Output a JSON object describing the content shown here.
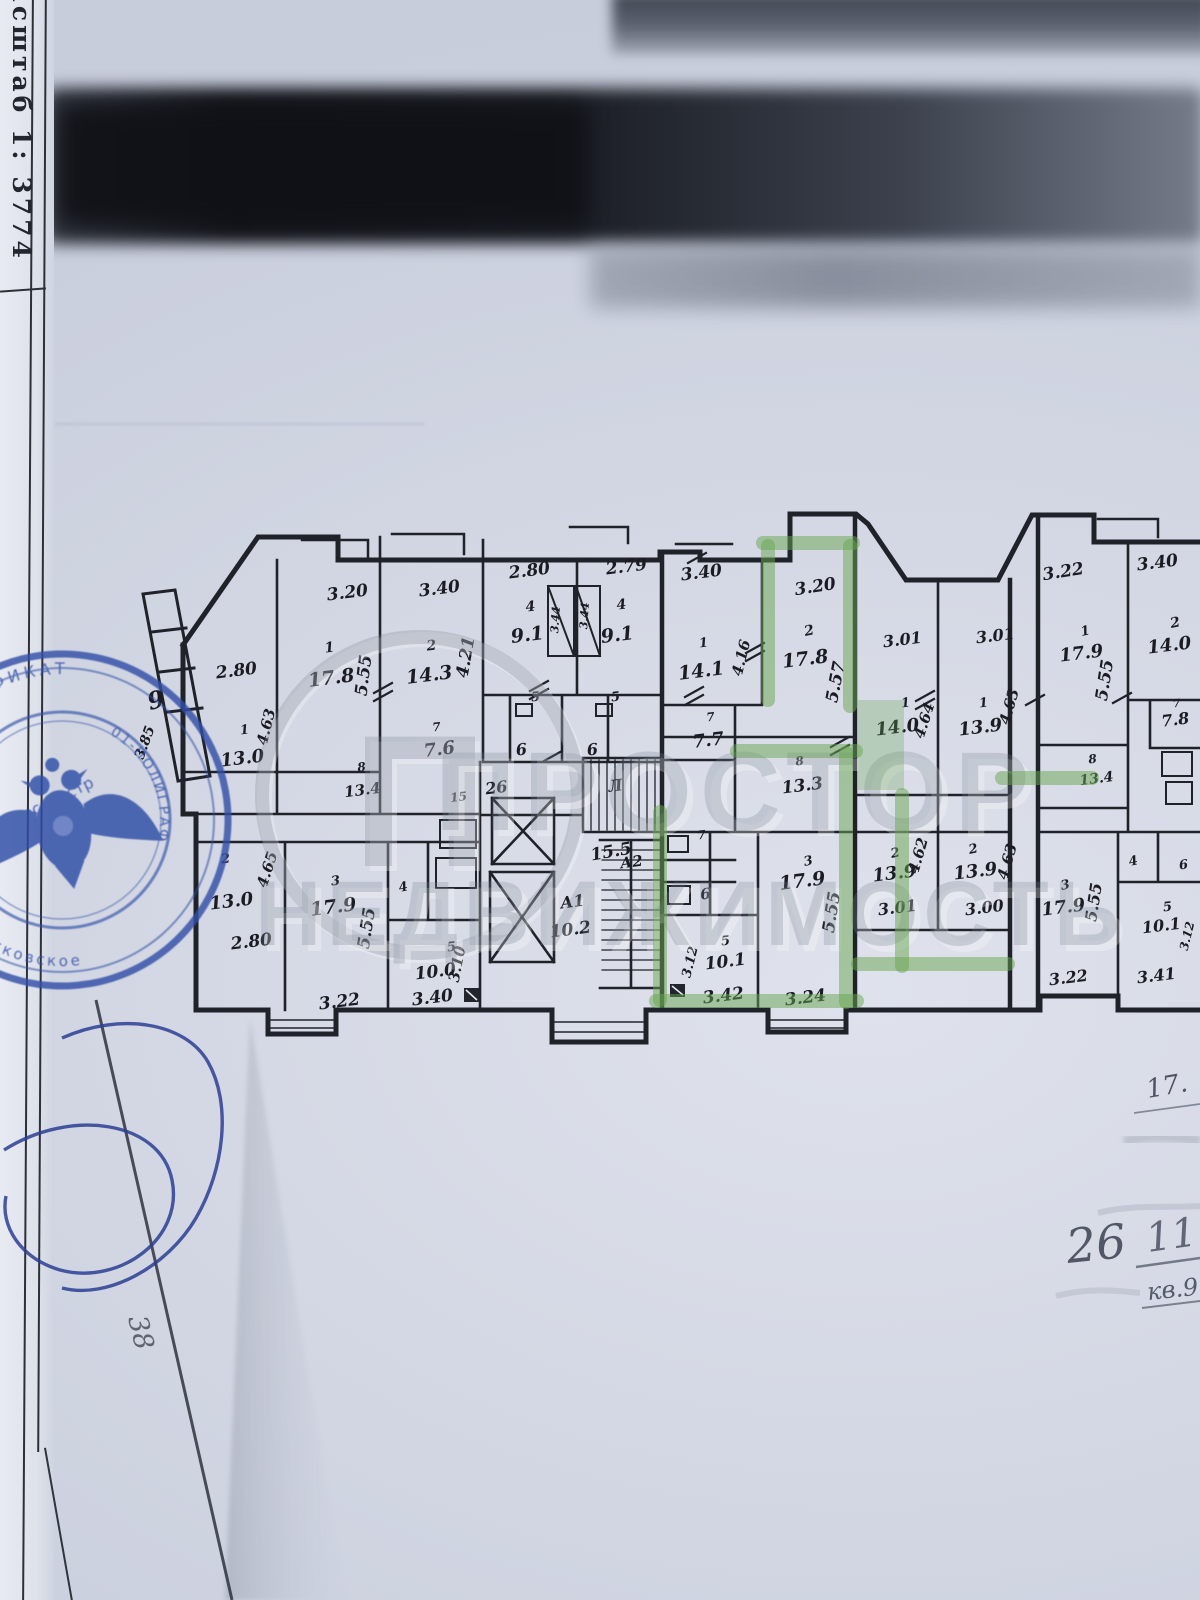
{
  "title_block": {
    "scale_label": "Масштаб 1:",
    "scale_value": "3774"
  },
  "watermark": {
    "logo_letter": "П",
    "line1": "ПРОСТОР",
    "line2": "НЕДВИЖИМОСТЬ"
  },
  "stamp": {
    "arc_top": "СЕРТИФИКАТ",
    "arc_left": "ное государственное",
    "word_center": "Росреестр",
    "arc_bottom": "Московское",
    "arc_right": "01-ПОЛИГРАФ",
    "small": "ОКПО"
  },
  "handwritten": {
    "floor_note": "17.",
    "entry_number": "26",
    "flat_number": "11",
    "apartment_note": "кв.9",
    "corner_mark": "38"
  },
  "plan": {
    "labels": [
      {
        "x": 348,
        "y": 598,
        "t": "3.20"
      },
      {
        "x": 330,
        "y": 652,
        "t": "1",
        "s": 14
      },
      {
        "x": 332,
        "y": 684,
        "t": "17.8",
        "s": 19
      },
      {
        "x": 369,
        "y": 676,
        "t": "5.55",
        "r": -83
      },
      {
        "x": 440,
        "y": 594,
        "t": "3.40"
      },
      {
        "x": 432,
        "y": 650,
        "t": "2",
        "s": 14
      },
      {
        "x": 430,
        "y": 681,
        "t": "14.3",
        "s": 19
      },
      {
        "x": 471,
        "y": 658,
        "t": "4.21",
        "r": -80
      },
      {
        "x": 237,
        "y": 676,
        "t": "2.80"
      },
      {
        "x": 245,
        "y": 734,
        "t": "1",
        "s": 13
      },
      {
        "x": 243,
        "y": 764,
        "t": "13.0",
        "s": 18
      },
      {
        "x": 271,
        "y": 728,
        "t": "4.63",
        "r": -76,
        "s": 15
      },
      {
        "x": 158,
        "y": 708,
        "t": "9",
        "s": 24,
        "r": -15
      },
      {
        "x": 149,
        "y": 744,
        "t": "3.85",
        "r": -70,
        "s": 14
      },
      {
        "x": 530,
        "y": 576,
        "t": "2.80"
      },
      {
        "x": 531,
        "y": 611,
        "t": "4",
        "s": 14
      },
      {
        "x": 528,
        "y": 641,
        "t": "9.1",
        "s": 19
      },
      {
        "x": 559,
        "y": 620,
        "t": "3.44",
        "r": -86,
        "s": 11
      },
      {
        "x": 588,
        "y": 616,
        "t": "3.44",
        "r": -86,
        "s": 11
      },
      {
        "x": 627,
        "y": 572,
        "t": "2.79"
      },
      {
        "x": 622,
        "y": 609,
        "t": "4",
        "s": 14
      },
      {
        "x": 618,
        "y": 641,
        "t": "9.1",
        "s": 19
      },
      {
        "x": 437,
        "y": 731,
        "t": "7",
        "s": 12
      },
      {
        "x": 440,
        "y": 755,
        "t": "7.6",
        "s": 18
      },
      {
        "x": 362,
        "y": 771,
        "t": "8",
        "s": 12
      },
      {
        "x": 363,
        "y": 795,
        "t": "13.4",
        "s": 15
      },
      {
        "x": 459,
        "y": 801,
        "t": "15",
        "s": 12
      },
      {
        "x": 497,
        "y": 793,
        "t": "26",
        "s": 16
      },
      {
        "x": 616,
        "y": 791,
        "t": "Л",
        "s": 16
      },
      {
        "x": 612,
        "y": 857,
        "t": "15.5",
        "r": -10
      },
      {
        "x": 573,
        "y": 907,
        "t": "А1",
        "s": 16
      },
      {
        "x": 571,
        "y": 935,
        "t": "10.2"
      },
      {
        "x": 632,
        "y": 867,
        "t": "А2",
        "s": 15
      },
      {
        "x": 226,
        "y": 863,
        "t": "2",
        "s": 13
      },
      {
        "x": 232,
        "y": 907,
        "t": "13.0",
        "s": 18
      },
      {
        "x": 272,
        "y": 871,
        "t": "4.65",
        "r": -72,
        "s": 15
      },
      {
        "x": 252,
        "y": 947,
        "t": "2.80"
      },
      {
        "x": 336,
        "y": 885,
        "t": "3",
        "s": 13
      },
      {
        "x": 334,
        "y": 913,
        "t": "17.9",
        "s": 19
      },
      {
        "x": 372,
        "y": 929,
        "t": "5.55",
        "r": -81
      },
      {
        "x": 404,
        "y": 891,
        "t": "4",
        "s": 13,
        "r": -12
      },
      {
        "x": 452,
        "y": 951,
        "t": "5",
        "s": 13
      },
      {
        "x": 436,
        "y": 977,
        "t": "10.0"
      },
      {
        "x": 462,
        "y": 965,
        "t": "3.10",
        "r": -79,
        "s": 15
      },
      {
        "x": 340,
        "y": 1007,
        "t": "3.22"
      },
      {
        "x": 433,
        "y": 1003,
        "t": "3.40"
      },
      {
        "x": 536,
        "y": 701,
        "t": "5",
        "s": 13
      },
      {
        "x": 616,
        "y": 701,
        "t": "5",
        "s": 13
      },
      {
        "x": 522,
        "y": 755,
        "t": "6",
        "s": 16
      },
      {
        "x": 593,
        "y": 755,
        "t": "6",
        "s": 16
      },
      {
        "x": 702,
        "y": 578,
        "t": "3.40"
      },
      {
        "x": 704,
        "y": 647,
        "t": "1",
        "s": 13
      },
      {
        "x": 702,
        "y": 677,
        "t": "14.1",
        "s": 19
      },
      {
        "x": 746,
        "y": 659,
        "t": "4.16",
        "r": -76,
        "s": 15
      },
      {
        "x": 816,
        "y": 592,
        "t": "3.20",
        "r": -9
      },
      {
        "x": 810,
        "y": 635,
        "t": "2",
        "s": 14,
        "r": -12
      },
      {
        "x": 806,
        "y": 665,
        "t": "17.8",
        "s": 19
      },
      {
        "x": 841,
        "y": 683,
        "t": "5.57",
        "r": -79
      },
      {
        "x": 711,
        "y": 721,
        "t": "7",
        "s": 12
      },
      {
        "x": 709,
        "y": 746,
        "t": "7.7",
        "s": 18
      },
      {
        "x": 800,
        "y": 765,
        "t": "8",
        "s": 12
      },
      {
        "x": 803,
        "y": 791,
        "t": "13.3"
      },
      {
        "x": 903,
        "y": 645,
        "t": "3.01",
        "s": 16
      },
      {
        "x": 996,
        "y": 641,
        "t": "3.01",
        "s": 16
      },
      {
        "x": 906,
        "y": 707,
        "t": "1",
        "s": 13
      },
      {
        "x": 898,
        "y": 733,
        "t": "14.0",
        "s": 18
      },
      {
        "x": 929,
        "y": 722,
        "t": "4.64",
        "r": -72,
        "s": 15
      },
      {
        "x": 984,
        "y": 707,
        "t": "1",
        "s": 13
      },
      {
        "x": 981,
        "y": 733,
        "t": "13.9",
        "s": 18
      },
      {
        "x": 1014,
        "y": 708,
        "t": "4.63",
        "r": -74,
        "s": 15
      },
      {
        "x": 809,
        "y": 865,
        "t": "3",
        "s": 13,
        "r": -12
      },
      {
        "x": 803,
        "y": 887,
        "t": "17.9",
        "s": 19
      },
      {
        "x": 837,
        "y": 913,
        "t": "5.55",
        "r": -81
      },
      {
        "x": 702,
        "y": 839,
        "t": "7",
        "s": 12
      },
      {
        "x": 706,
        "y": 899,
        "t": "6",
        "s": 15
      },
      {
        "x": 726,
        "y": 945,
        "t": "5",
        "s": 13
      },
      {
        "x": 726,
        "y": 967,
        "t": "10.1"
      },
      {
        "x": 694,
        "y": 963,
        "t": "3.12",
        "r": -76,
        "s": 13
      },
      {
        "x": 724,
        "y": 1001,
        "t": "3.42"
      },
      {
        "x": 806,
        "y": 1003,
        "t": "3.24"
      },
      {
        "x": 896,
        "y": 857,
        "t": "2",
        "s": 13,
        "r": -12
      },
      {
        "x": 895,
        "y": 879,
        "t": "13.9",
        "s": 18
      },
      {
        "x": 923,
        "y": 857,
        "t": "4.62",
        "r": -74,
        "s": 15
      },
      {
        "x": 898,
        "y": 913,
        "t": "3.01",
        "s": 16
      },
      {
        "x": 974,
        "y": 853,
        "t": "2",
        "s": 13,
        "r": -12
      },
      {
        "x": 976,
        "y": 877,
        "t": "13.9",
        "s": 18
      },
      {
        "x": 1012,
        "y": 863,
        "t": "4.63",
        "r": -74,
        "s": 15
      },
      {
        "x": 985,
        "y": 913,
        "t": "3.00",
        "s": 16
      },
      {
        "x": 1064,
        "y": 577,
        "t": "3.22",
        "r": -9
      },
      {
        "x": 1158,
        "y": 568,
        "t": "3.40"
      },
      {
        "x": 1086,
        "y": 635,
        "t": "1",
        "s": 13,
        "r": -12
      },
      {
        "x": 1082,
        "y": 659,
        "t": "17.9",
        "s": 18
      },
      {
        "x": 1110,
        "y": 681,
        "t": "5.55",
        "r": -81
      },
      {
        "x": 1176,
        "y": 627,
        "t": "2",
        "s": 14,
        "r": -12
      },
      {
        "x": 1170,
        "y": 651,
        "t": "14.0",
        "s": 18
      },
      {
        "x": 1177,
        "y": 707,
        "t": "7",
        "s": 11
      },
      {
        "x": 1176,
        "y": 725,
        "t": "7.8",
        "s": 16
      },
      {
        "x": 1093,
        "y": 763,
        "t": "8",
        "s": 12
      },
      {
        "x": 1097,
        "y": 783,
        "t": "13.4",
        "s": 14
      },
      {
        "x": 1134,
        "y": 865,
        "t": "4",
        "s": 13,
        "r": -12
      },
      {
        "x": 1184,
        "y": 869,
        "t": "6",
        "s": 13
      },
      {
        "x": 1066,
        "y": 889,
        "t": "3",
        "s": 13,
        "r": -12
      },
      {
        "x": 1064,
        "y": 913,
        "t": "17.9",
        "s": 18
      },
      {
        "x": 1099,
        "y": 903,
        "t": "5.55",
        "r": -81,
        "s": 16
      },
      {
        "x": 1168,
        "y": 911,
        "t": "5",
        "s": 13
      },
      {
        "x": 1162,
        "y": 931,
        "t": "10.1",
        "s": 16
      },
      {
        "x": 1191,
        "y": 937,
        "t": "3.12",
        "r": -76,
        "s": 12
      },
      {
        "x": 1069,
        "y": 983,
        "t": "3.22",
        "s": 16
      },
      {
        "x": 1157,
        "y": 981,
        "t": "3.41",
        "s": 16
      }
    ]
  }
}
